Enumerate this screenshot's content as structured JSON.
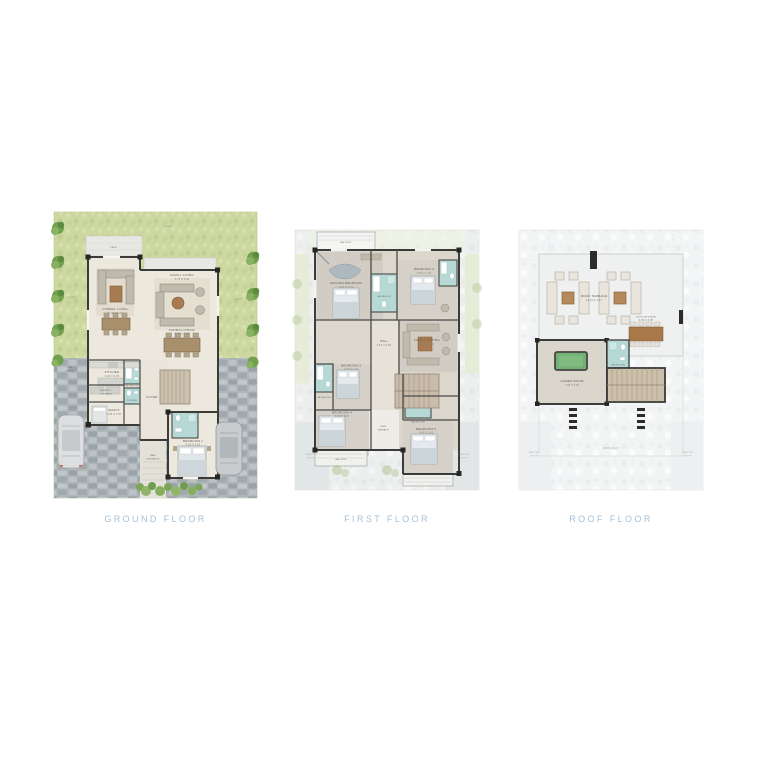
{
  "palette": {
    "caption_color": "#a6c1d8",
    "lawn_green": "#ccd8a0",
    "driveway_stone": "#aeb6ba",
    "wall_dark": "#3b3b39",
    "bathroom_teal": "#b7d9d6",
    "wood_brown": "#a8906c",
    "games_table_green": "#74b074"
  },
  "ground_floor": {
    "caption": "GROUND FLOOR",
    "labels": {
      "lawn_top": "LAWN",
      "lawn_left": "LAWN",
      "lawn_right": "LAWN",
      "patio": "PATIO",
      "car_porch_1": "CAR",
      "car_porch_2": "PORCH",
      "formal_living": "FORMAL LIVING",
      "formal_living_dims": "4.75 X 5.25",
      "family_living": "FAMILY LIVING",
      "family_living_dims": "4.75 X 5.25",
      "formal_dining": "FORMAL DINING",
      "formal_dining_dims": "4.75 X 3.40",
      "kitchen": "KITCHEN",
      "kitchen_dims": "4.30 X 6.35",
      "laundry_1": "LAUNDRY +",
      "laundry_2": "STORAGE",
      "maids": "MAID'S",
      "maids_dims": "3.05 X 2.60",
      "bathroom": "BATHROOM",
      "powder": "POWDER",
      "foyer": "FOYER",
      "bedroom": "BEDROOM 1",
      "bedroom_dims": "4.00 X 3.65",
      "entrance_1": "MAIN",
      "entrance_2": "ENTRANCE"
    }
  },
  "first_floor": {
    "caption": "FIRST FLOOR",
    "labels": {
      "balcony_top": "BALCONY",
      "master": "MASTER BEDROOM",
      "master_dims": "5.25 X 4.75",
      "master_bath": "BATHROOM",
      "bedroom2": "BEDROOM 2",
      "bedroom2_dims": "3.50 X 4.20",
      "family_sitting": "FAMILY SITTING",
      "family_sitting_dims": "4.75 X 4.10",
      "hall": "HALL",
      "hall_dims": "3.10 X 3.60",
      "bedroom3": "BEDROOM 3",
      "bedroom3_dims": "3.50 X 4.20",
      "bathroom": "BATHROOM",
      "bedroom4": "BEDROOM 4",
      "bedroom4_dims": "4.00 X 3.65",
      "terrace_1": "OPEN",
      "terrace_2": "TERRACE",
      "bathroom2": "BATHROOM",
      "bedroom5": "BEDROOM 5",
      "bedroom5_dims": "4.00 X 3.65",
      "balcony_bottom": "BALCONY",
      "carport_left_1": "CARPORT",
      "carport_left_2": "ROOF",
      "carport_right_1": "CARPORT",
      "carport_right_2": "ROOF"
    }
  },
  "roof_floor": {
    "caption": "ROOF FLOOR",
    "labels": {
      "roof_terrace": "ROOF TERRACE",
      "roof_terrace_dims": "11.24 X 4.67",
      "outdoor_dining": "OUTDOOR DINING",
      "outdoor_dining_dims": "4.50 X 4.05",
      "games_room": "GAMES ROOM",
      "games_room_dims": "4.95 X 5.50",
      "bathroom": "BATHROOM",
      "roof_deck": "ROOF DECK",
      "carport_left_1": "CARPORT",
      "carport_left_2": "ROOF",
      "carport_right_1": "CARPORT",
      "carport_right_2": "ROOF"
    }
  }
}
